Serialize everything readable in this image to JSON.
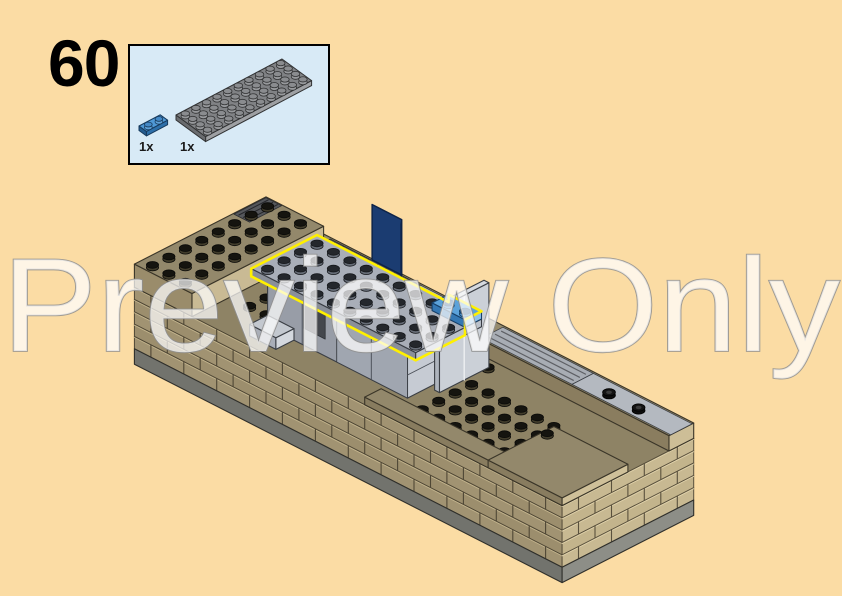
{
  "step": {
    "number": "60"
  },
  "parts_callout": {
    "parts": [
      {
        "count": "1x",
        "name": "plate-1x2-blue"
      },
      {
        "count": "1x",
        "name": "plate-4x10-dark-gray"
      }
    ]
  },
  "watermark": {
    "text": "Preview Only"
  },
  "colors": {
    "background": "#FBDCA4",
    "callout_bg": "#D8EAF6",
    "callout_border": "#000000",
    "highlight_yellow": "#FFF000",
    "tan_deck": "#8E8365",
    "tan_wall": "#A19372",
    "tan_wall_light": "#C8B992",
    "tan_top_light": "#93886B",
    "gray_plate": "#A9AEB8",
    "gray_structure": "#989DA7",
    "gray_light": "#C6CBD3",
    "blue_plate": "#4F98D5",
    "flag_blue": "#1B3C71",
    "base_gray": "#72736D",
    "stud_dark": "#15140F",
    "thumb_gray": "#808285",
    "watermark_stroke": "#8F8F8F"
  }
}
